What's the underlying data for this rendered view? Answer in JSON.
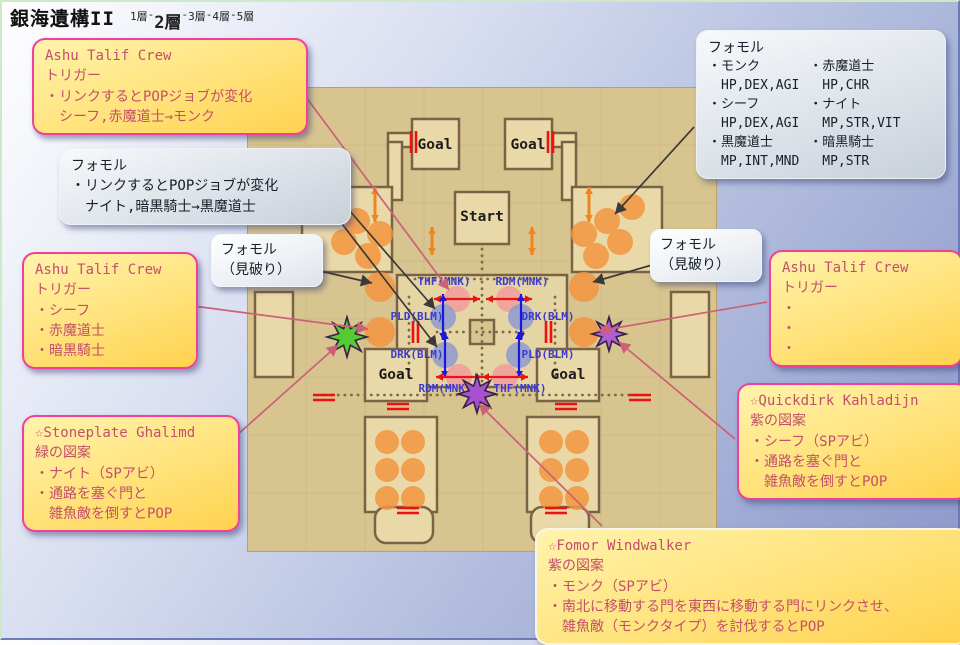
{
  "title": "銀海遺構II",
  "floor_nav": {
    "separator": "-",
    "floors": [
      "1層",
      "2層",
      "3層",
      "4層",
      "5層"
    ],
    "active_index": 1
  },
  "callouts": {
    "ashu_top_left": {
      "title": "Ashu Talif Crew",
      "lines": [
        "トリガー",
        "・リンクするとPOPジョブが変化",
        "　シーフ,赤魔道士→モンク"
      ]
    },
    "fomor_link": {
      "lines": [
        "フォモル",
        "・リンクするとPOPジョブが変化",
        "　ナイト,暗黒騎士→黒魔道士"
      ]
    },
    "fomor_stats": {
      "title": "フォモル",
      "columns": [
        [
          {
            "job": "・モンク",
            "stats": "HP,DEX,AGI"
          },
          {
            "job": "・シーフ",
            "stats": "HP,DEX,AGI"
          },
          {
            "job": "・黒魔道士",
            "stats": "MP,INT,MND"
          }
        ],
        [
          {
            "job": "・赤魔道士",
            "stats": "HP,CHR"
          },
          {
            "job": "・ナイト",
            "stats": "MP,STR,VIT"
          },
          {
            "job": "・暗黒騎士",
            "stats": "MP,STR"
          }
        ]
      ]
    },
    "miyaburi_left": {
      "lines": [
        "フォモル",
        "（見破り）"
      ]
    },
    "miyaburi_right": {
      "lines": [
        "フォモル",
        "（見破り）"
      ]
    },
    "ashu_left": {
      "title": "Ashu Talif Crew",
      "lines": [
        "トリガー",
        "・シーフ",
        "・赤魔道士",
        "・暗黒騎士"
      ]
    },
    "ashu_right": {
      "title": "Ashu Talif Crew",
      "lines": [
        "トリガー",
        "・",
        "・",
        "・"
      ]
    },
    "stoneplate": {
      "lines": [
        "☆Stoneplate Ghalimd",
        "緑の図案",
        "・ナイト（SPアビ）",
        "・通路を塞ぐ門と",
        "　雑魚敵を倒すとPOP"
      ]
    },
    "quickdirk": {
      "lines": [
        "☆Quickdirk Kahladijn",
        "紫の図案",
        "・シーフ（SPアビ）",
        "・通路を塞ぐ門と",
        "　雑魚敵を倒すとPOP"
      ]
    },
    "windwalker": {
      "lines": [
        "☆Fomor Windwalker",
        "紫の図案",
        "・モンク（SPアビ）",
        "・南北に移動する門を東西に移動する門にリンクさせ、",
        "　雑魚敵（モンクタイプ）を討伐するとPOP"
      ]
    }
  },
  "map": {
    "room_labels": {
      "goal_top_left": "Goal",
      "goal_top_right": "Goal",
      "start": "Start",
      "goal_mid_left": "Goal",
      "goal_mid_right": "Goal"
    },
    "gate_markers": [
      {
        "label": "THF(MNK)",
        "type": "red",
        "cx": 210,
        "cy": 212,
        "lx": 197,
        "ly": 198
      },
      {
        "label": "RDM(MNK)",
        "type": "red",
        "cx": 262,
        "cy": 212,
        "lx": 275,
        "ly": 198
      },
      {
        "label": "PLD(BLM)",
        "type": "blue",
        "cx": 196,
        "cy": 230,
        "lx": 170,
        "ly": 233
      },
      {
        "label": "DRK(BLM)",
        "type": "blue",
        "cx": 274,
        "cy": 230,
        "lx": 301,
        "ly": 233
      },
      {
        "label": "DRK(BLM)",
        "type": "blue",
        "cx": 198,
        "cy": 268,
        "lx": 170,
        "ly": 271
      },
      {
        "label": "PLD(BLM)",
        "type": "blue",
        "cx": 272,
        "cy": 268,
        "lx": 301,
        "ly": 271
      },
      {
        "label": "RDM(MNK)",
        "type": "red",
        "cx": 212,
        "cy": 290,
        "lx": 198,
        "ly": 305
      },
      {
        "label": "THF(MNK)",
        "type": "red",
        "cx": 258,
        "cy": 290,
        "lx": 273,
        "ly": 305
      }
    ],
    "enemy_clusters": [
      {
        "r": 13,
        "c": [
          [
            85,
            120
          ],
          [
            110,
            134
          ],
          [
            133,
            147
          ],
          [
            97,
            155
          ],
          [
            121,
            169
          ]
        ]
      },
      {
        "r": 13,
        "c": [
          [
            385,
            120
          ],
          [
            360,
            134
          ],
          [
            337,
            147
          ],
          [
            373,
            155
          ],
          [
            349,
            169
          ]
        ]
      },
      {
        "r": 12,
        "c": [
          [
            140,
            355
          ],
          [
            166,
            355
          ],
          [
            140,
            383
          ],
          [
            166,
            383
          ],
          [
            140,
            411
          ],
          [
            166,
            411
          ]
        ]
      },
      {
        "r": 12,
        "c": [
          [
            304,
            355
          ],
          [
            330,
            355
          ],
          [
            304,
            383
          ],
          [
            330,
            383
          ],
          [
            304,
            411
          ],
          [
            330,
            411
          ]
        ]
      },
      {
        "r": 15,
        "c": [
          [
            133,
            200
          ],
          [
            133,
            245
          ],
          [
            337,
            200
          ],
          [
            337,
            245
          ]
        ]
      }
    ],
    "orange_arrows": [
      {
        "x": 128,
        "y1": 100,
        "y2": 135
      },
      {
        "x": 185,
        "y1": 140,
        "y2": 168
      },
      {
        "x": 342,
        "y1": 100,
        "y2": 135
      },
      {
        "x": 285,
        "y1": 140,
        "y2": 168
      }
    ],
    "red_gates": [
      {
        "x": 164,
        "y": 44,
        "o": "v"
      },
      {
        "x": 301,
        "y": 44,
        "o": "v"
      },
      {
        "x": 166,
        "y": 234,
        "o": "v"
      },
      {
        "x": 299,
        "y": 234,
        "o": "v"
      },
      {
        "x": 66,
        "y": 308,
        "o": "h"
      },
      {
        "x": 382,
        "y": 308,
        "o": "h"
      },
      {
        "x": 140,
        "y": 317,
        "o": "h"
      },
      {
        "x": 308,
        "y": 317,
        "o": "h"
      },
      {
        "x": 150,
        "y": 421,
        "o": "h"
      },
      {
        "x": 298,
        "y": 421,
        "o": "h"
      }
    ],
    "stars": [
      {
        "name": "green-pop-star",
        "x": 100,
        "y": 250,
        "r": 20,
        "color": "#55cc33"
      },
      {
        "name": "purple-pop-star-east",
        "x": 362,
        "y": 247,
        "r": 17,
        "color": "#b05fd3"
      },
      {
        "name": "purple-pop-star-south",
        "x": 230,
        "y": 307,
        "r": 19,
        "color": "#a851d0"
      }
    ]
  },
  "connectors": {
    "pink": [
      {
        "x1": 284,
        "y1": 68,
        "x2": 447,
        "y2": 288
      },
      {
        "x1": 176,
        "y1": 302,
        "x2": 366,
        "y2": 327
      },
      {
        "x1": 216,
        "y1": 450,
        "x2": 336,
        "y2": 343
      },
      {
        "x1": 765,
        "y1": 300,
        "x2": 596,
        "y2": 329
      },
      {
        "x1": 733,
        "y1": 437,
        "x2": 617,
        "y2": 340
      },
      {
        "x1": 600,
        "y1": 524,
        "x2": 477,
        "y2": 402
      }
    ],
    "black": [
      {
        "x1": 327,
        "y1": 185,
        "x2": 433,
        "y2": 307
      },
      {
        "x1": 327,
        "y1": 205,
        "x2": 435,
        "y2": 345
      },
      {
        "x1": 305,
        "y1": 266,
        "x2": 370,
        "y2": 281
      },
      {
        "x1": 650,
        "y1": 263,
        "x2": 591,
        "y2": 280
      },
      {
        "x1": 692,
        "y1": 125,
        "x2": 613,
        "y2": 212
      }
    ]
  },
  "colors": {
    "box_border_pink": "#f0409c",
    "box_text_red": "#c2506b",
    "label_blue": "#3b3bd0",
    "gate_red": "#e81515",
    "gate_blue": "#1818e0",
    "gate_circle_red": "#f09a9a",
    "gate_circle_blue": "#8a97cf",
    "enemy_orange": "#f2953f",
    "orange_arrow": "#f0851e",
    "map_red_gate": "#ee1111",
    "connector_pink": "#cc6077",
    "connector_black": "#3a3a3a",
    "map_wall": "#7a6244",
    "map_bg": "#d8c48f",
    "room_fill": "#ead9a8"
  }
}
